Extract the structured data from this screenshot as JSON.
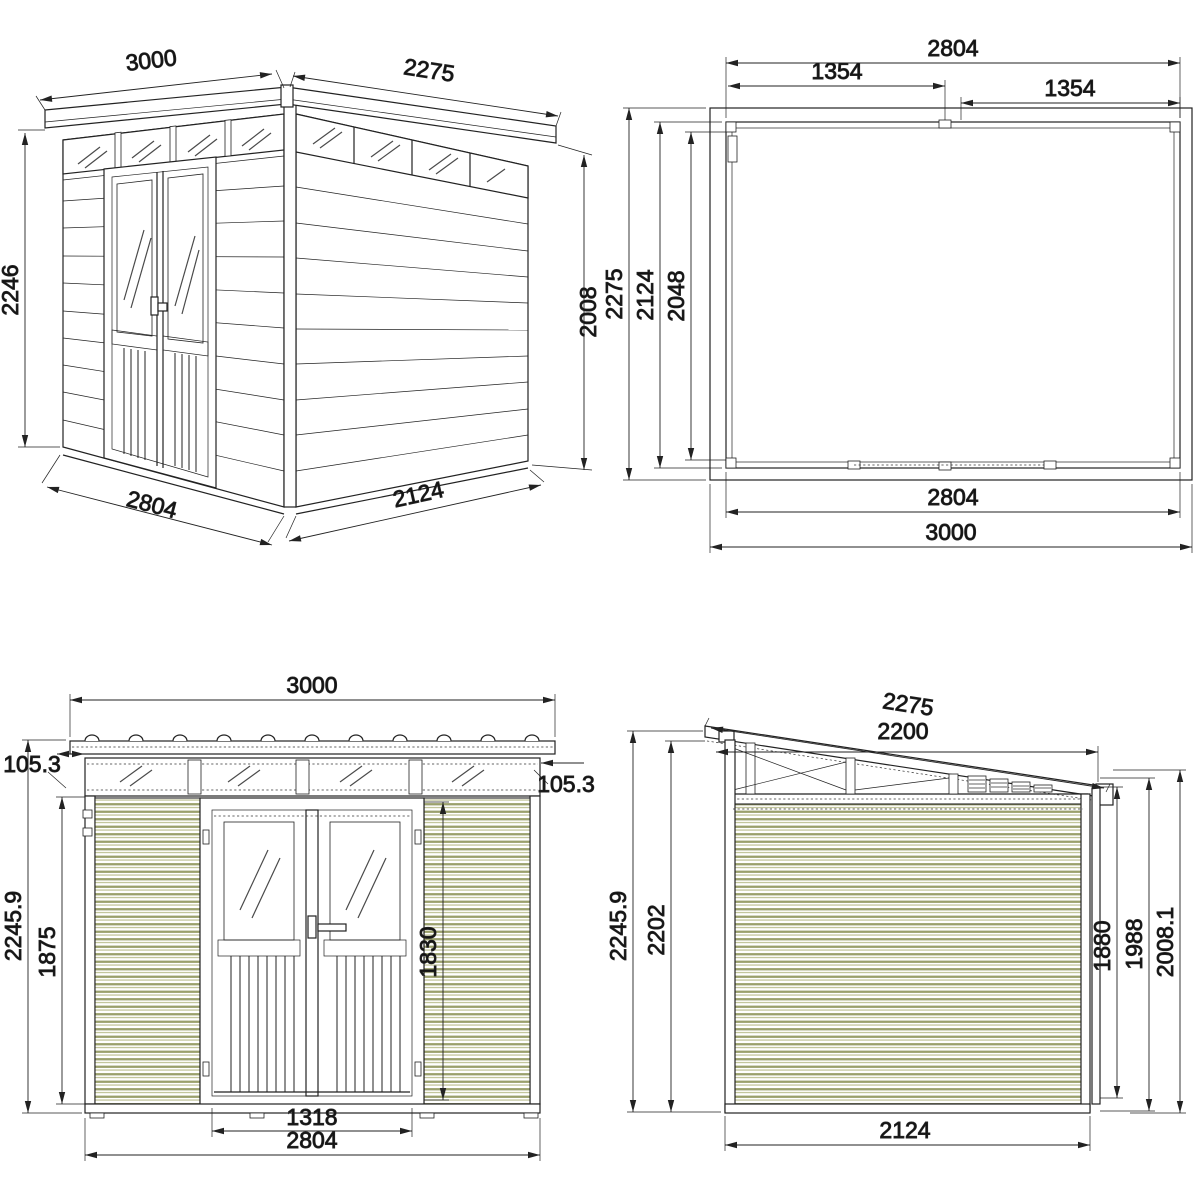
{
  "page": {
    "background": "#ffffff",
    "units": "mm"
  },
  "style": {
    "line_color": "#222222",
    "text_color": "#111111",
    "siding_stripe_dark": "#9aa06c",
    "siding_stripe_light": "#c3c69c",
    "glass_stroke": "#4a4a4a"
  },
  "views": {
    "perspective": {
      "name": "Perspective view",
      "dims": {
        "roof_front_edge_mm": "3000",
        "roof_side_edge_mm": "2275",
        "front_height_mm": "2246",
        "side_wall_height_mm": "2008",
        "front_width_mm": "2804",
        "side_depth_mm": "2124"
      }
    },
    "plan": {
      "name": "Roof plan view",
      "dims": {
        "inner_width_top_mm": "2804",
        "half_width_left_mm": "1354",
        "half_width_right_mm": "1354",
        "outer_depth_mm": "2275",
        "inner_depth_mm": "2124",
        "clear_depth_mm": "2048",
        "inner_width_bottom_mm": "2804",
        "outer_width_mm": "3000"
      }
    },
    "front": {
      "name": "Front elevation",
      "dims": {
        "overall_width_mm": "3000",
        "eave_overhang_left_mm": "105.3",
        "eave_overhang_right_mm": "105.3",
        "overall_height_mm": "2245.9",
        "wall_height_mm": "1875",
        "door_height_mm": "1830",
        "door_width_mm": "1318",
        "body_width_mm": "2804"
      }
    },
    "side": {
      "name": "Side elevation",
      "dims": {
        "roof_slope_length_mm": "2275",
        "roof_plan_length_mm": "2200",
        "overall_height_mm": "2245.9",
        "front_wall_height_mm": "2202",
        "side_panel_height_mm": "1880",
        "mid_height_mm": "1988",
        "rear_height_mm": "2008.1",
        "depth_mm": "2124"
      }
    }
  }
}
